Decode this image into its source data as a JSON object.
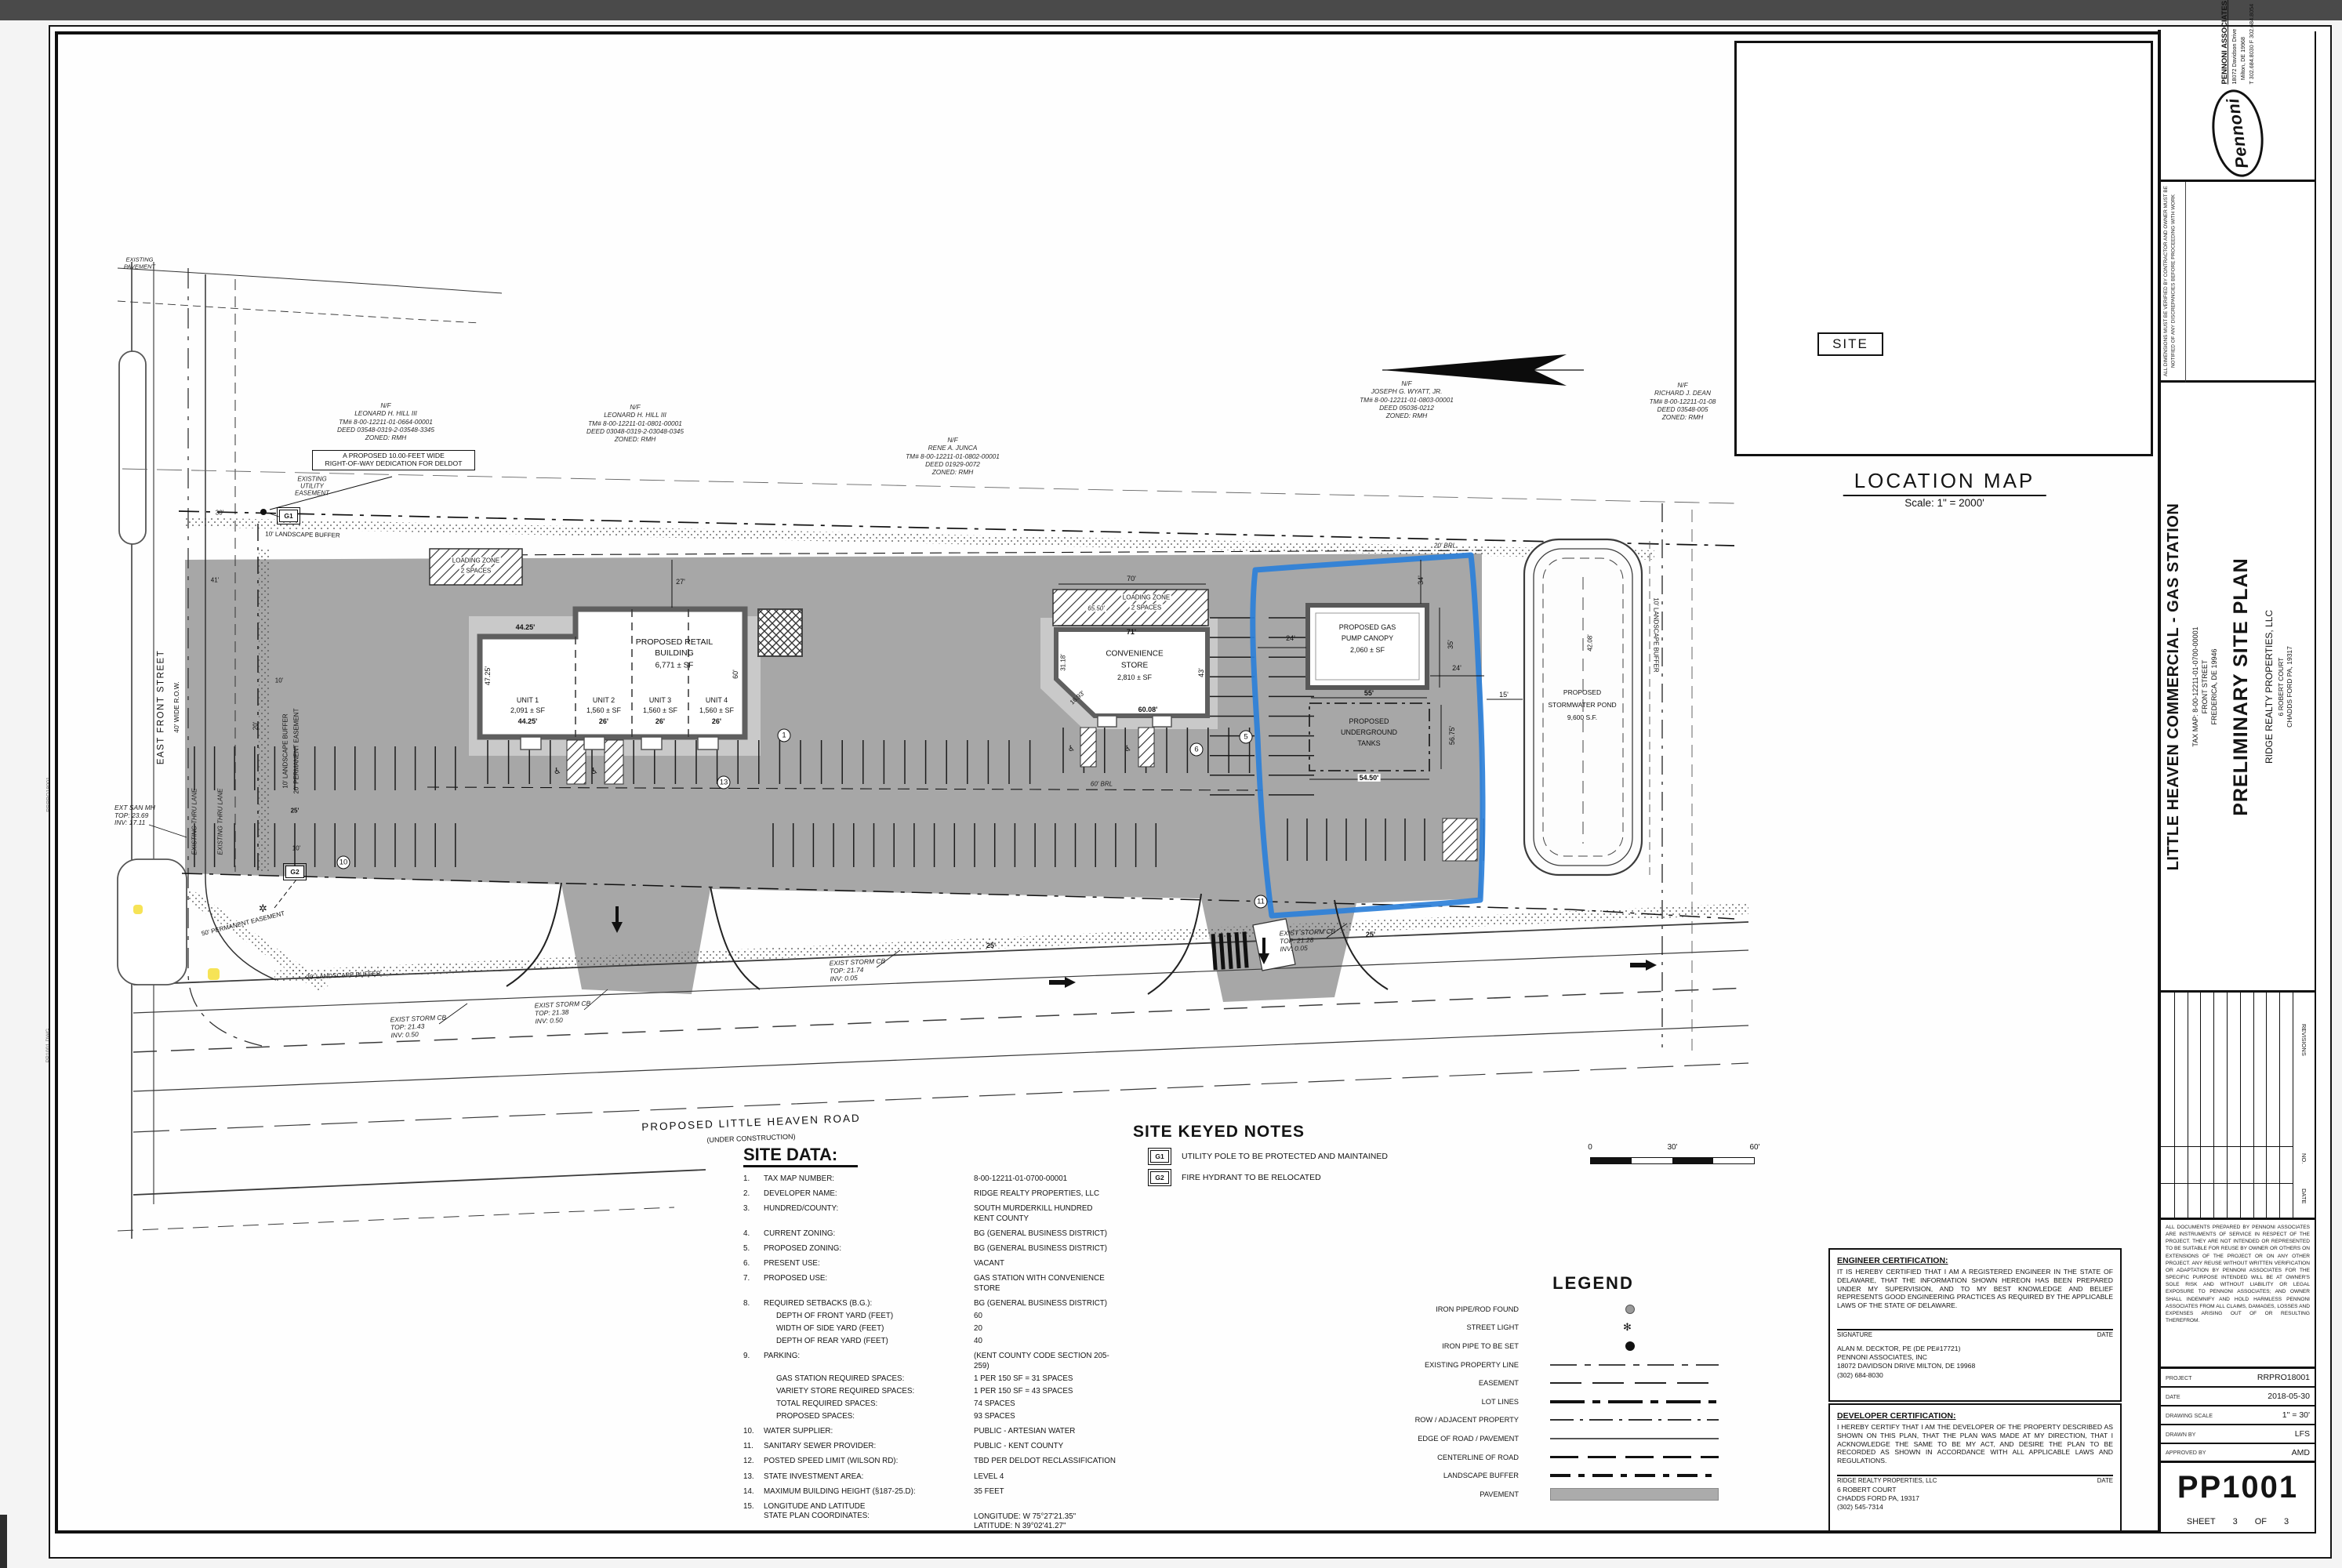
{
  "margin": {
    "stamp1": "PLOTTED: 2018-05-30",
    "stamp2": "RRPRO18001",
    "stamp3": "PP1001.DWG"
  },
  "title_block": {
    "logo_text": "Pennoni",
    "firm": "PENNONI ASSOCIATES INC.",
    "addr1": "18072 Davidson Drive",
    "addr2": "Milton, DE 19968",
    "addr3": "T 302.684.8030   F 302.684.8054",
    "note": "ALL DIMENSIONS MUST BE VERIFIED BY CONTRACTOR AND OWNER MUST BE NOTIFIED OF ANY DISCREPANCIES BEFORE PROCEEDING WITH WORK",
    "project_title": "LITTLE HEAVEN COMMERCIAL - GAS STATION",
    "sub1": "TAX MAP: 8-00-12211-01-0700-00001",
    "sub2": "FRONT STREET",
    "sub3": "FREDERICA, DE 19946",
    "sheet_title": "PRELIMINARY SITE PLAN",
    "client": "RIDGE REALTY PROPERTIES, LLC",
    "client_addr1": "6 ROBERT COURT",
    "client_addr2": "CHADDS FORD PA, 19317",
    "rev_label": "REVISIONS",
    "no_label": "NO.",
    "date_label": "DATE",
    "disclaimer": "ALL DOCUMENTS PREPARED BY PENNONI ASSOCIATES ARE INSTRUMENTS OF SERVICE IN RESPECT OF THE PROJECT. THEY ARE NOT INTENDED OR REPRESENTED TO BE SUITABLE FOR REUSE BY OWNER OR OTHERS ON EXTENSIONS OF THE PROJECT OR ON ANY OTHER PROJECT. ANY REUSE WITHOUT WRITTEN VERIFICATION OR ADAPTATION BY PENNONI ASSOCIATES FOR THE SPECIFIC PURPOSE INTENDED WILL BE AT OWNER'S SOLE RISK AND WITHOUT LIABILITY OR LEGAL EXPOSURE TO PENNONI ASSOCIATES; AND OWNER SHALL INDEMNIFY AND HOLD HARMLESS PENNONI ASSOCIATES FROM ALL CLAIMS, DAMAGES, LOSSES AND EXPENSES ARISING OUT OF OR RESULTING THEREFROM.",
    "rows": [
      {
        "label": "PROJECT",
        "value": "RRPRO18001"
      },
      {
        "label": "DATE",
        "value": "2018-05-30"
      },
      {
        "label": "DRAWING SCALE",
        "value": "1\" = 30'"
      },
      {
        "label": "DRAWN BY",
        "value": "LFS"
      },
      {
        "label": "APPROVED BY",
        "value": "AMD"
      }
    ],
    "number": "PP1001",
    "sheet_label": "SHEET",
    "sheet_no": "3",
    "of_label": "OF",
    "sheet_total": "3"
  },
  "location_map": {
    "title": "LOCATION MAP",
    "scale": "Scale: 1\" = 2000'",
    "site_label": "SITE"
  },
  "keyed_notes": {
    "title": "SITE KEYED NOTES",
    "notes": [
      {
        "key": "G1",
        "text": "UTILITY POLE TO BE PROTECTED AND MAINTAINED"
      },
      {
        "key": "G2",
        "text": "FIRE HYDRANT TO BE RELOCATED"
      }
    ]
  },
  "scale_bar": {
    "t0": "0",
    "t30": "30'",
    "t60": "60'"
  },
  "site_data": {
    "title": "SITE DATA:",
    "items": [
      {
        "no": "1.",
        "label": "TAX MAP NUMBER:",
        "value": "8-00-12211-01-0700-00001"
      },
      {
        "no": "2.",
        "label": "DEVELOPER NAME:",
        "value": "RIDGE REALTY PROPERTIES, LLC"
      },
      {
        "no": "3.",
        "label": "HUNDRED/COUNTY:",
        "value": "SOUTH MURDERKILL HUNDRED",
        "value2": "KENT COUNTY"
      },
      {
        "no": "4.",
        "label": "CURRENT ZONING:",
        "value": "BG (GENERAL BUSINESS DISTRICT)"
      },
      {
        "no": "5.",
        "label": "PROPOSED ZONING:",
        "value": "BG (GENERAL BUSINESS DISTRICT)"
      },
      {
        "no": "6.",
        "label": "PRESENT USE:",
        "value": "VACANT"
      },
      {
        "no": "7.",
        "label": "PROPOSED USE:",
        "value": "GAS STATION WITH CONVENIENCE STORE"
      },
      {
        "no": "8.",
        "label": "REQUIRED SETBACKS (B.G.):",
        "value": "BG (GENERAL BUSINESS DISTRICT)",
        "sub": [
          {
            "label": "DEPTH OF FRONT YARD (FEET)",
            "value": "60"
          },
          {
            "label": "WIDTH OF SIDE YARD (FEET)",
            "value": "20"
          },
          {
            "label": "DEPTH OF REAR YARD (FEET)",
            "value": "40"
          }
        ]
      },
      {
        "no": "9.",
        "label": "PARKING:",
        "value": "(KENT COUNTY CODE SECTION 205-259)",
        "sub": [
          {
            "label": "GAS STATION REQUIRED SPACES:",
            "value": "1 PER 150 SF = 31 SPACES"
          },
          {
            "label": "VARIETY STORE REQUIRED SPACES:",
            "value": "1 PER 150 SF = 43 SPACES"
          },
          {
            "label": "TOTAL REQUIRED SPACES:",
            "value": "74 SPACES"
          },
          {
            "label": "PROPOSED SPACES:",
            "value": "93 SPACES"
          }
        ]
      },
      {
        "no": "10.",
        "label": "WATER SUPPLIER:",
        "value": "PUBLIC - ARTESIAN WATER"
      },
      {
        "no": "11.",
        "label": "SANITARY SEWER PROVIDER:",
        "value": "PUBLIC - KENT COUNTY"
      },
      {
        "no": "12.",
        "label": "POSTED SPEED LIMIT (WILSON RD):",
        "value": "TBD PER DELDOT RECLASSIFICATION"
      },
      {
        "no": "13.",
        "label": "STATE INVESTMENT AREA:",
        "value": "LEVEL 4"
      },
      {
        "no": "14.",
        "label": "MAXIMUM BUILDING HEIGHT (§187-25.D):",
        "value": "35 FEET"
      },
      {
        "no": "15.",
        "label": "LONGITUDE AND LATITUDE",
        "label2": "STATE PLAN COORDINATES:",
        "value": "LONGITUDE: W 75°27'21.35\"",
        "value2": "LATITUDE: N 39°02'41.27\""
      }
    ]
  },
  "legend": {
    "title": "LEGEND",
    "items": [
      {
        "label": "IRON PIPE/ROD FOUND"
      },
      {
        "label": "STREET LIGHT"
      },
      {
        "label": "IRON PIPE TO BE SET"
      },
      {
        "label": "EXISTING PROPERTY LINE"
      },
      {
        "label": "EASEMENT"
      },
      {
        "label": "LOT LINES"
      },
      {
        "label": "ROW / ADJACENT PROPERTY"
      },
      {
        "label": "EDGE OF ROAD / PAVEMENT"
      },
      {
        "label": "CENTERLINE OF ROAD"
      },
      {
        "label": "LANDSCAPE BUFFER"
      },
      {
        "label": "PAVEMENT"
      }
    ],
    "street_light_glyph": "✻"
  },
  "certs": {
    "eng_title": "ENGINEER CERTIFICATION:",
    "eng_body": "IT IS HEREBY CERTIFIED THAT I AM A REGISTERED ENGINEER IN THE STATE OF DELAWARE, THAT THE INFORMATION SHOWN HEREON HAS BEEN PREPARED UNDER MY SUPERVISION, AND TO MY BEST KNOWLEDGE AND BELIEF REPRESENTS GOOD ENGINEERING PRACTICES AS REQUIRED BY THE APPLICABLE LAWS OF THE STATE OF DELAWARE.",
    "sig_label": "SIGNATURE",
    "date_label": "DATE",
    "eng_name": "ALAN M. DECKTOR, PE    (DE PE#17721)",
    "eng_firm": "PENNONI ASSOCIATES, INC",
    "eng_addr": "18072 DAVIDSON DRIVE MILTON, DE 19968",
    "eng_phone": "(302) 684-8030",
    "dev_title": "DEVELOPER CERTIFICATION:",
    "dev_body": "I HEREBY CERTIFY THAT I AM THE DEVELOPER OF THE PROPERTY DESCRIBED AS SHOWN ON THIS PLAN, THAT THE PLAN WAS MADE AT MY DIRECTION, THAT I ACKNOWLEDGE THE SAME TO BE MY ACT, AND DESIRE THE PLAN TO BE RECORDED AS SHOWN IN ACCORDANCE WITH ALL APPLICABLE LAWS AND REGULATIONS.",
    "dev_name": "RIDGE REALTY PROPERTIES, LLC",
    "dev_addr1": "6 ROBERT COURT",
    "dev_addr2": "CHADDS FORD PA, 19317",
    "dev_phone": "(302) 545-7314"
  },
  "plan": {
    "retail_l1": "PROPOSED RETAIL",
    "retail_l2": "BUILDING",
    "retail_sf": "6,771 ± SF",
    "units": [
      {
        "n": "UNIT 1",
        "sf": "2,091 ± SF",
        "w": "44.25'"
      },
      {
        "n": "UNIT 2",
        "sf": "1,560 ± SF",
        "w": "26'"
      },
      {
        "n": "UNIT 3",
        "sf": "1,560 ± SF",
        "w": "26'"
      },
      {
        "n": "UNIT 4",
        "sf": "1,560 ± SF",
        "w": "26'"
      }
    ],
    "conv_l1": "CONVENIENCE",
    "conv_l2": "STORE",
    "conv_sf": "2,810 ± SF",
    "canopy_l1": "PROPOSED GAS",
    "canopy_l2": "PUMP CANOPY",
    "canopy_sf": "2,060 ± SF",
    "tanks_l1": "PROPOSED",
    "tanks_l2": "UNDERGROUND",
    "tanks_l3": "TANKS",
    "pond_l1": "PROPOSED",
    "pond_l2": "STORMWATER POND",
    "pond_sf": "9,600 S.F.",
    "loading_l1": "LOADING ZONE",
    "loading_l2": "2 SPACES",
    "road_l1": "PROPOSED LITTLE HEAVEN ROAD",
    "road_l2": "(UNDER CONSTRUCTION)",
    "street_l1": "EAST FRONT STREET",
    "street_l2": "40' WIDE R.O.W.",
    "thru_lane": "EXISTING THRU LANE",
    "buf_left1": "10' LANDSCAPE BUFFER",
    "buf_left2": "20' PERMANENT EASEMENT",
    "buf_top": "10' LANDSCAPE BUFFER",
    "buf_right": "10' LANDSCAPE BUFFER",
    "buf_bottom": "20' LANDSCAPE BUFFER",
    "perm50": "50' PERMANENT EASEMENT",
    "brl20": "20' BRL",
    "brl60": "60' BRL",
    "callout_l1": "A PROPOSED 10.00-FEET WIDE",
    "callout_l2": "RIGHT-OF-WAY DEDICATION FOR DELDOT",
    "ease_l1": "EXISTING",
    "ease_l2": "UTILITY",
    "ease_l3": "EASEMENT",
    "pave_l1": "EXISTING",
    "pave_l2": "PAVEMENT",
    "san_l1": "EXT SAN MH",
    "san_l2": "TOP: 23.69",
    "san_l3": "INV: 17.11",
    "cb": "EXIST STORM CB",
    "cb1_top": "TOP: 21.43",
    "cb1_inv": "INV: 0.50",
    "cb2_top": "TOP: 21.38",
    "cb2_inv": "INV: 0.50",
    "cb3_top": "TOP: 21.74",
    "cb3_inv": "INV: 0.05",
    "cb4_top": "TOP: 21.28",
    "cb4_inv": "INV: 0.05",
    "owners": [
      {
        "nf": "N/F",
        "name": "LEONARD H. HILL III",
        "tm": "TM# 8-00-12211-01-0664-00001",
        "deed": "DEED 03548-0319-2-03548-3345",
        "zoned": "ZONED: RMH"
      },
      {
        "nf": "N/F",
        "name": "LEONARD H. HILL III",
        "tm": "TM# 8-00-12211-01-0801-00001",
        "deed": "DEED 03048-0319-2-03048-0345",
        "zoned": "ZONED: RMH"
      },
      {
        "nf": "N/F",
        "name": "RENE A. JUNCA",
        "tm": "TM# 8-00-12211-01-0802-00001",
        "deed": "DEED 01929-0072",
        "zoned": "ZONED: RMH"
      },
      {
        "nf": "N/F",
        "name": "JOSEPH G. WYATT, JR.",
        "tm": "TM# 8-00-12211-01-0803-00001",
        "deed": "DEED 05036-0212",
        "zoned": "ZONED: RMH"
      },
      {
        "nf": "N/F",
        "name": "RICHARD J. DEAN",
        "tm": "TM# 8-00-12211-01-08",
        "deed": "DEED 03548-005",
        "zoned": "ZONED: RMH"
      }
    ],
    "dims": {
      "d44": "44.25'",
      "d4725": "47.25'",
      "d60": "60'",
      "d27": "27'",
      "d24": "24'",
      "d71": "71'",
      "d70": "70'",
      "d6550": "65.50'",
      "d3118": "31.18'",
      "d1693": "16.93'",
      "d6008": "60.08'",
      "d43": "43'",
      "d34": "34'",
      "d35": "35'",
      "d55": "55'",
      "d5450": "54.50'",
      "d5675": "56.75'",
      "d15": "15'",
      "d4208": "42.08'",
      "d30": "30'",
      "d41": "41'",
      "d10": "10'",
      "d25": "25'",
      "d20": "20'"
    },
    "circ": {
      "c1": "1",
      "c5": "5",
      "c6": "6",
      "c10": "10",
      "c11": "11",
      "c13": "13"
    }
  }
}
